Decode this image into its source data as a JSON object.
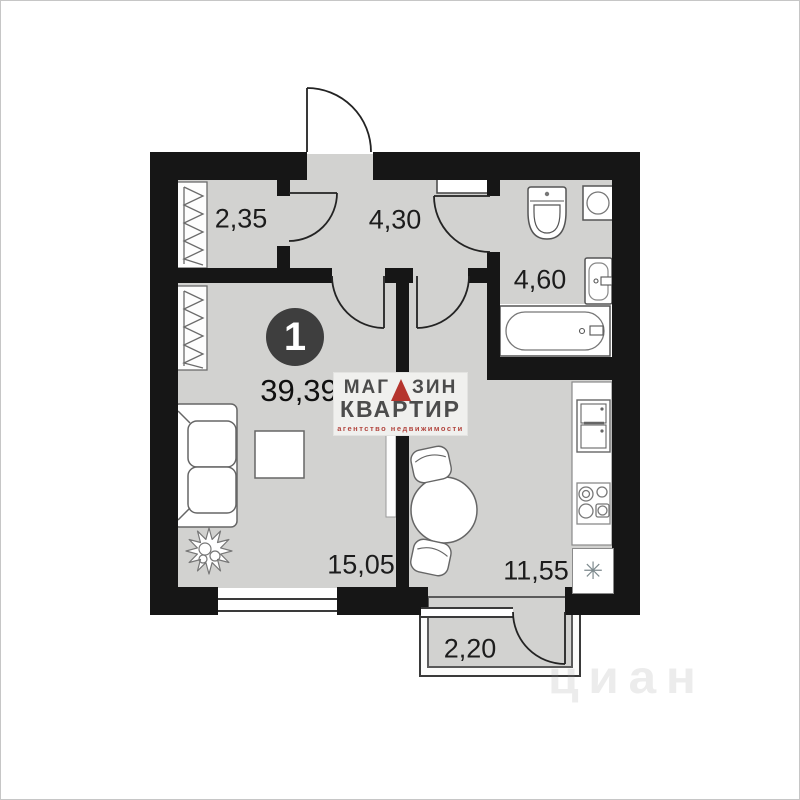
{
  "plan": {
    "unit_badge": "1",
    "total_area": "39,39",
    "rooms": [
      {
        "id": "wardrobe",
        "area": "2,35"
      },
      {
        "id": "hallway",
        "area": "4,30"
      },
      {
        "id": "bathroom",
        "area": "4,60"
      },
      {
        "id": "living-room",
        "area": "15,05"
      },
      {
        "id": "kitchen",
        "area": "11,55"
      },
      {
        "id": "balcony",
        "area": "2,20"
      }
    ],
    "sink_marker": "✳"
  },
  "logo": {
    "word1_left": "МАГ",
    "word1_right": "ЗИН",
    "word2": "КВАРТИР",
    "tagline": "агентство недвижимости"
  },
  "watermark": "циан",
  "colors": {
    "wall": "#161616",
    "floor": "#d2d2d0",
    "accent_red": "#b5342d",
    "label_text": "#1c1c1c",
    "fixture_stroke": "#666666"
  },
  "icons": [
    "entry-door-arc-icon",
    "interior-door-arc-icon",
    "wardrobe-hatch-icon",
    "sofa-icon",
    "table-icon",
    "plant-icon",
    "round-table-icon",
    "chair-icon",
    "toilet-icon",
    "washing-machine-icon",
    "bath-sink-icon",
    "bathtub-icon",
    "fridge-icon",
    "stove-icon",
    "kitchen-sink-asterisk-icon",
    "window-icon"
  ]
}
